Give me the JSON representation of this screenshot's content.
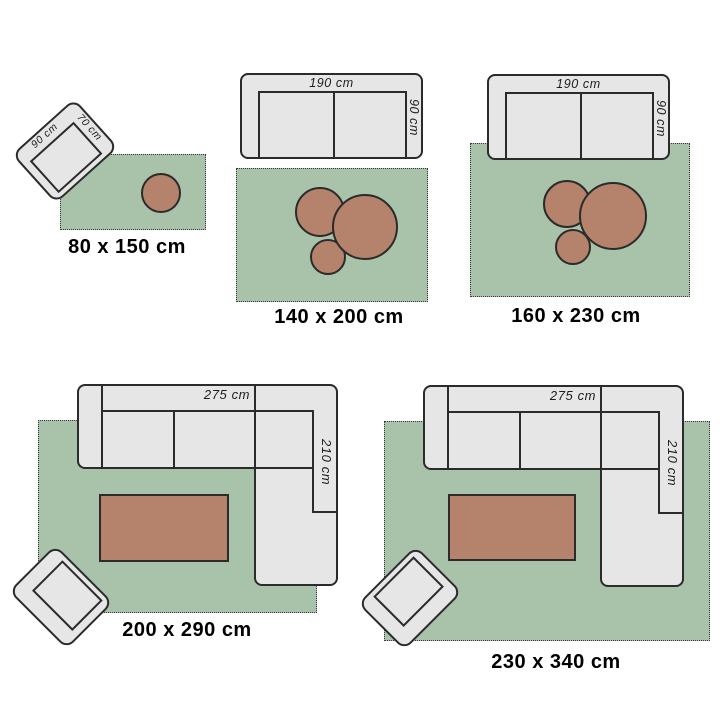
{
  "title": "rug size guide",
  "colors": {
    "background": "#ffffff",
    "rug": "#a9c3ab",
    "furniture": "#e6e6e6",
    "table": "#b5826b",
    "outline": "#2b2b2b",
    "dim_text": "#1d1d1d",
    "label_text": "#000000",
    "rug_dot": "#3a3a3a"
  },
  "groups": {
    "tl": {
      "size_label": "80 x 150 cm",
      "chair": {
        "width_label": "90 cm",
        "depth_label": "70 cm"
      }
    },
    "tm": {
      "size_label": "140 x 200 cm",
      "sofa": {
        "width_label": "190 cm",
        "depth_label": "90 cm"
      }
    },
    "tr": {
      "size_label": "160 x 230 cm",
      "sofa": {
        "width_label": "190 cm",
        "depth_label": "90 cm"
      }
    },
    "bl": {
      "size_label": "200 x 290 cm",
      "sofa": {
        "width_label": "275 cm",
        "depth_label": "210 cm"
      }
    },
    "br": {
      "size_label": "230 x 340 cm",
      "sofa": {
        "width_label": "275 cm",
        "depth_label": "210 cm"
      }
    }
  }
}
